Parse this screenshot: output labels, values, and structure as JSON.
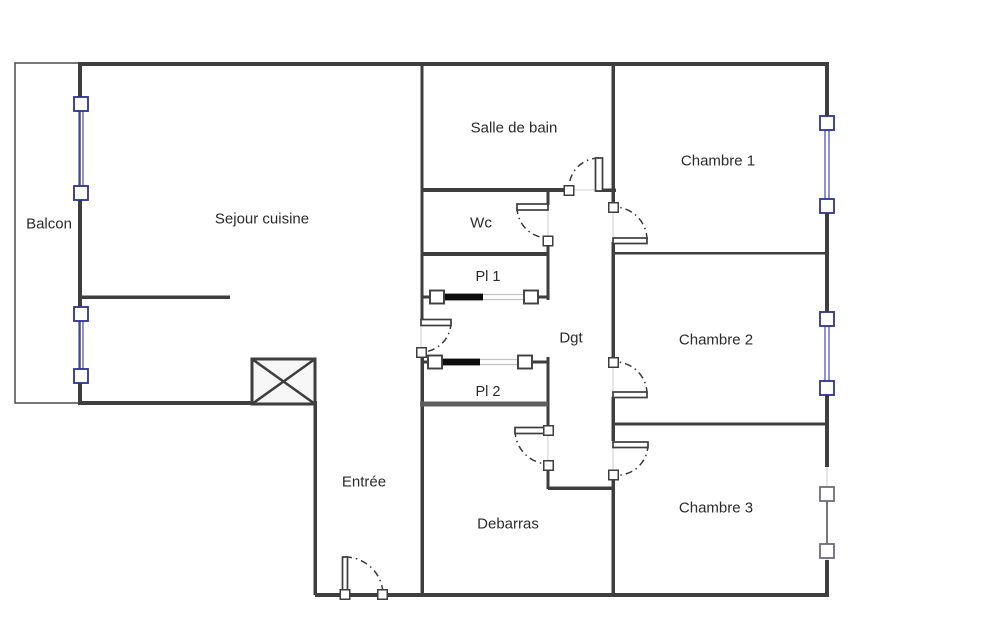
{
  "plan_title": "Apartment floor plan",
  "colors": {
    "wall": "#3e3e3e",
    "wall_light": "#5f5f5f",
    "window_border": "#2e3192",
    "window_line": "#4a4aa8",
    "gray_window_border": "#6d6d78",
    "gray_window_line": "#555555",
    "text": "#2b2b2b",
    "arc": "#3a3a3a",
    "leaf_border": "#3e3e3e",
    "leaf_fill": "#ffffff",
    "track": "#c2c2c2",
    "slider_bar": "#0c0c0c",
    "faint": "#cccccc",
    "shaft_fill": "#f7f7f7",
    "balcony_border": "#4a4a4a"
  },
  "rooms": [
    {
      "name": "balcon",
      "label": "Balcon",
      "x": 49,
      "y": 224,
      "size": 15
    },
    {
      "name": "sejour-cuisine",
      "label": "Sejour cuisine",
      "x": 262,
      "y": 219,
      "size": 15
    },
    {
      "name": "salle-de-bain",
      "label": "Salle de bain",
      "x": 514,
      "y": 128,
      "size": 15
    },
    {
      "name": "wc",
      "label": "Wc",
      "x": 481,
      "y": 223,
      "size": 15
    },
    {
      "name": "pl1",
      "label": "Pl 1",
      "x": 488,
      "y": 277,
      "size": 14.5
    },
    {
      "name": "pl2",
      "label": "Pl 2",
      "x": 488,
      "y": 392,
      "size": 14.5
    },
    {
      "name": "dgt",
      "label": "Dgt",
      "x": 571,
      "y": 338,
      "size": 15
    },
    {
      "name": "chambre-1",
      "label": "Chambre 1",
      "x": 718,
      "y": 161,
      "size": 15
    },
    {
      "name": "chambre-2",
      "label": "Chambre 2",
      "x": 716,
      "y": 340,
      "size": 15
    },
    {
      "name": "chambre-3",
      "label": "Chambre 3",
      "x": 716,
      "y": 508,
      "size": 15
    },
    {
      "name": "entree",
      "label": "Entrée",
      "x": 364,
      "y": 482,
      "size": 15
    },
    {
      "name": "debarras",
      "label": "Debarras",
      "x": 508,
      "y": 524,
      "size": 15
    }
  ],
  "balcony": {
    "x": 15,
    "y": 63,
    "w": 65,
    "h": 340
  },
  "shaft": {
    "x": 252,
    "y": 359,
    "w": 63,
    "h": 45
  },
  "walls": [
    {
      "n": "outer-top",
      "x1": 78,
      "y1": 64,
      "x2": 829,
      "y2": 64,
      "w": 4
    },
    {
      "n": "outer-left-a",
      "x1": 80,
      "y1": 62,
      "x2": 80,
      "y2": 99,
      "w": 4
    },
    {
      "n": "outer-left-b",
      "x1": 80,
      "y1": 198,
      "x2": 80,
      "y2": 309,
      "w": 4
    },
    {
      "n": "outer-left-c",
      "x1": 80,
      "y1": 381,
      "x2": 80,
      "y2": 405,
      "w": 4
    },
    {
      "n": "outer-right-a",
      "x1": 827,
      "y1": 62,
      "x2": 827,
      "y2": 118,
      "w": 4
    },
    {
      "n": "outer-right-b",
      "x1": 827,
      "y1": 212,
      "x2": 827,
      "y2": 314,
      "w": 4
    },
    {
      "n": "outer-right-c",
      "x1": 827,
      "y1": 393,
      "x2": 827,
      "y2": 467,
      "w": 4
    },
    {
      "n": "outer-right-d",
      "x1": 827,
      "y1": 560,
      "x2": 827,
      "y2": 597,
      "w": 4
    },
    {
      "n": "outer-bottom",
      "x1": 315,
      "y1": 595,
      "x2": 829,
      "y2": 595,
      "w": 4
    },
    {
      "n": "sejour-bottom",
      "x1": 78,
      "y1": 403,
      "x2": 254,
      "y2": 403,
      "w": 4
    },
    {
      "n": "entree-left",
      "x1": 315,
      "y1": 401,
      "x2": 315,
      "y2": 595,
      "w": 3.5
    },
    {
      "n": "middle-upper",
      "x1": 422,
      "y1": 64,
      "x2": 422,
      "y2": 322,
      "w": 3
    },
    {
      "n": "middle-lower",
      "x1": 422,
      "y1": 352,
      "x2": 422,
      "y2": 595,
      "w": 3.5
    },
    {
      "n": "sdb-bottom",
      "x1": 422,
      "y1": 190,
      "x2": 566,
      "y2": 190,
      "w": 4
    },
    {
      "n": "sdb-stub",
      "x1": 596,
      "y1": 190,
      "x2": 616,
      "y2": 190,
      "w": 3.5
    },
    {
      "n": "corridor-right-a",
      "x1": 613,
      "y1": 63,
      "x2": 613,
      "y2": 204,
      "w": 3.5
    },
    {
      "n": "corridor-right-b",
      "x1": 613,
      "y1": 242,
      "x2": 613,
      "y2": 359,
      "w": 3.5
    },
    {
      "n": "corridor-right-c",
      "x1": 613,
      "y1": 397,
      "x2": 613,
      "y2": 441,
      "w": 3.5
    },
    {
      "n": "corridor-right-d",
      "x1": 613,
      "y1": 478,
      "x2": 613,
      "y2": 595,
      "w": 3.5
    },
    {
      "n": "corridor-left-a",
      "x1": 548,
      "y1": 190,
      "x2": 548,
      "y2": 205,
      "w": 3
    },
    {
      "n": "corridor-left-b",
      "x1": 548,
      "y1": 243,
      "x2": 548,
      "y2": 300,
      "w": 3
    },
    {
      "n": "wc-bottom",
      "x1": 421,
      "y1": 254,
      "x2": 548,
      "y2": 254,
      "w": 4
    },
    {
      "n": "pl2-right",
      "x1": 548,
      "y1": 357,
      "x2": 548,
      "y2": 427,
      "w": 3
    },
    {
      "n": "corridor-left-c",
      "x1": 548,
      "y1": 469,
      "x2": 548,
      "y2": 489,
      "w": 3
    },
    {
      "n": "corridor-end",
      "x1": 548,
      "y1": 488,
      "x2": 614,
      "y2": 488,
      "w": 3.5
    },
    {
      "n": "pl2-bottom",
      "x1": 420,
      "y1": 404,
      "x2": 548,
      "y2": 404,
      "w": 5,
      "c": "wall_light"
    },
    {
      "n": "ch1-ch2-divider",
      "x1": 613,
      "y1": 253,
      "x2": 828,
      "y2": 253,
      "w": 2.5
    },
    {
      "n": "ch2-ch3-divider",
      "x1": 613,
      "y1": 424,
      "x2": 828,
      "y2": 424,
      "w": 3
    },
    {
      "n": "kitchen-wall",
      "x1": 80,
      "y1": 297,
      "x2": 230,
      "y2": 297,
      "w": 3.5
    },
    {
      "n": "pl1-stub-left",
      "x1": 421,
      "y1": 297,
      "x2": 430,
      "y2": 297,
      "w": 3
    },
    {
      "n": "pl1-stub-right",
      "x1": 538,
      "y1": 297,
      "x2": 548,
      "y2": 297,
      "w": 3
    },
    {
      "n": "pl2-stub-left",
      "x1": 421,
      "y1": 362,
      "x2": 428,
      "y2": 362,
      "w": 3
    },
    {
      "n": "pl2-stub-right",
      "x1": 532,
      "y1": 362,
      "x2": 548,
      "y2": 362,
      "w": 3
    }
  ],
  "faint_lines": [
    {
      "x1": 421,
      "y1": 326,
      "x2": 421,
      "y2": 348
    },
    {
      "x1": 548,
      "y1": 210,
      "x2": 548,
      "y2": 237
    },
    {
      "x1": 569,
      "y1": 190,
      "x2": 595,
      "y2": 190
    },
    {
      "x1": 613,
      "y1": 211,
      "x2": 613,
      "y2": 237
    },
    {
      "x1": 613,
      "y1": 366,
      "x2": 613,
      "y2": 392
    },
    {
      "x1": 613,
      "y1": 447,
      "x2": 613,
      "y2": 471
    },
    {
      "x1": 548,
      "y1": 435,
      "x2": 548,
      "y2": 461
    },
    {
      "x1": 349,
      "y1": 595,
      "x2": 378,
      "y2": 595
    },
    {
      "x1": 827,
      "y1": 467,
      "x2": 827,
      "y2": 560
    }
  ],
  "windows": [
    {
      "name": "balcony-window-1",
      "x": 81,
      "y1": 97,
      "y2": 200,
      "style": "blue"
    },
    {
      "name": "balcony-window-2",
      "x": 81,
      "y1": 307,
      "y2": 383,
      "style": "blue"
    },
    {
      "name": "chambre1-window",
      "x": 827,
      "y1": 116,
      "y2": 213,
      "style": "blue"
    },
    {
      "name": "chambre2-window",
      "x": 827,
      "y1": 312,
      "y2": 395,
      "style": "blue"
    },
    {
      "name": "chambre3-window",
      "x": 827,
      "y1": 487,
      "y2": 558,
      "style": "gray"
    }
  ],
  "sliding_doors": [
    {
      "name": "pl1-sliding-door",
      "y": 297,
      "sq1": 437,
      "bar": [
        444,
        483
      ],
      "track": [
        483,
        524
      ],
      "sq2": 531
    },
    {
      "name": "pl2-sliding-door",
      "y": 362,
      "sq1": 435,
      "bar": [
        442,
        480
      ],
      "track": [
        480,
        518
      ],
      "sq2": 525
    }
  ],
  "swing_doors": [
    {
      "name": "sejour-dgt-door",
      "leaf": [
        421,
        319.5,
        30,
        6
      ],
      "arc": "M451 322 A30 30 0 0 1 421 352",
      "squares": [
        [
          421.5,
          352.5
        ]
      ]
    },
    {
      "name": "wc-door",
      "leaf": [
        517,
        204,
        31,
        6
      ],
      "arc": "M517 207 A31 31 0 0 0 548 238",
      "squares": [
        [
          548,
          241
        ]
      ]
    },
    {
      "name": "sdb-door",
      "leaf": [
        595.5,
        158,
        7,
        33
      ],
      "arc": "M599 158 A30 30 0 0 0 569 188",
      "squares": [
        [
          569,
          190.5
        ]
      ]
    },
    {
      "name": "chambre1-door",
      "leaf": [
        613,
        238,
        34,
        5.5
      ],
      "arc": "M647 240 A33 33 0 0 0 613 207",
      "squares": [
        [
          613.5,
          207.5
        ]
      ]
    },
    {
      "name": "chambre2-door",
      "leaf": [
        613,
        392,
        34,
        5.5
      ],
      "arc": "M647 394 A32 32 0 0 0 613 362",
      "squares": [
        [
          613.5,
          362.5
        ]
      ]
    },
    {
      "name": "chambre3-door",
      "leaf": [
        613,
        442,
        35,
        5.5
      ],
      "arc": "M648 444 A31 31 0 0 1 613 475",
      "squares": [
        [
          613.5,
          475
        ]
      ]
    },
    {
      "name": "debarras-door",
      "leaf": [
        515,
        427.5,
        33,
        6
      ],
      "arc": "M515 430 A34 34 0 0 0 548 464",
      "squares": [
        [
          548.5,
          430.5
        ],
        [
          548.5,
          465.5
        ]
      ]
    },
    {
      "name": "entrance-door",
      "leaf": [
        342.5,
        557,
        5,
        38
      ],
      "arc": "M345 557 A38 38 0 0 1 383 595",
      "squares": [
        [
          345,
          594.5
        ],
        [
          382.5,
          594.5
        ]
      ]
    }
  ]
}
